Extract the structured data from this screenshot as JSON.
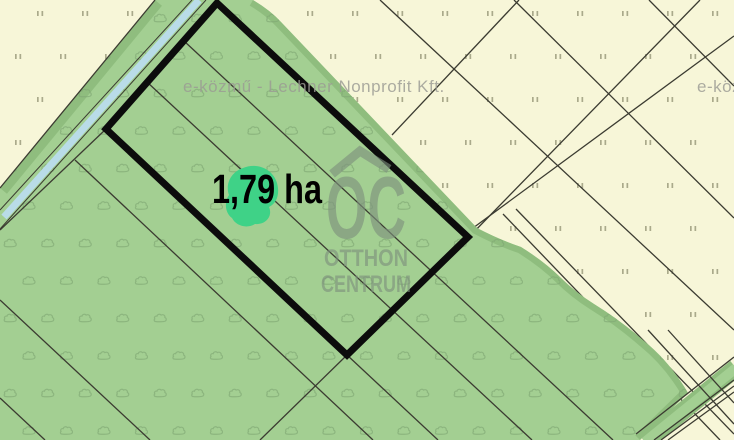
{
  "labels": {
    "area": "1,79 ha",
    "provider_watermark": "e-közmű - Lechner Nonprofit Kft.",
    "logo_monogram": "OC",
    "logo_line1": "OTTHON",
    "logo_line2": "CENTRUM"
  },
  "colors": {
    "cream": "#f7f6d8",
    "green": "#a3cf92",
    "green_dark_edge": "#8fbd7e",
    "stream": "#b9dce8",
    "outline": "#0c0c0c",
    "parcel_line": "#3b3b31",
    "tree_symbol": "#7fa873",
    "grass_symbol": "#a6a687",
    "highlight_blob": "#3fd287",
    "watermark_text": "#9b9b94",
    "logo_color": "#7d907d",
    "area_label_color": "#000000"
  }
}
